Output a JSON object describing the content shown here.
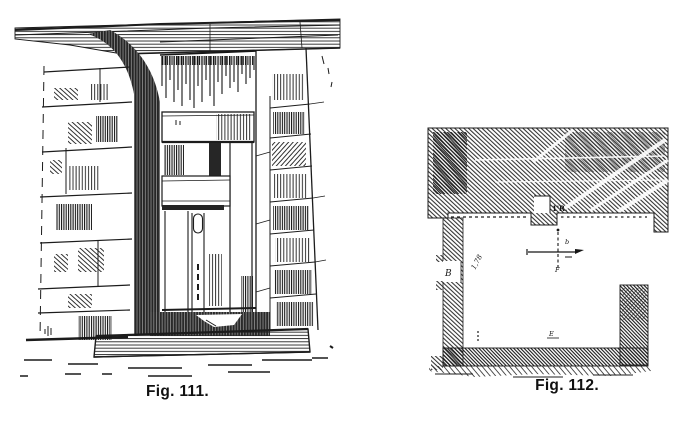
{
  "page": {
    "background": "#ffffff",
    "ink": "#1c1c1c"
  },
  "figures": {
    "fig111": {
      "caption": "Fig. 111."
    },
    "fig112": {
      "caption": "Fig. 112.",
      "plan_labels": {
        "niche": "B",
        "top_measure": "1'R.",
        "left_measure": "1,78",
        "bottom_mark": "E",
        "cross_upper": "b",
        "cross_lower": "F"
      }
    }
  }
}
